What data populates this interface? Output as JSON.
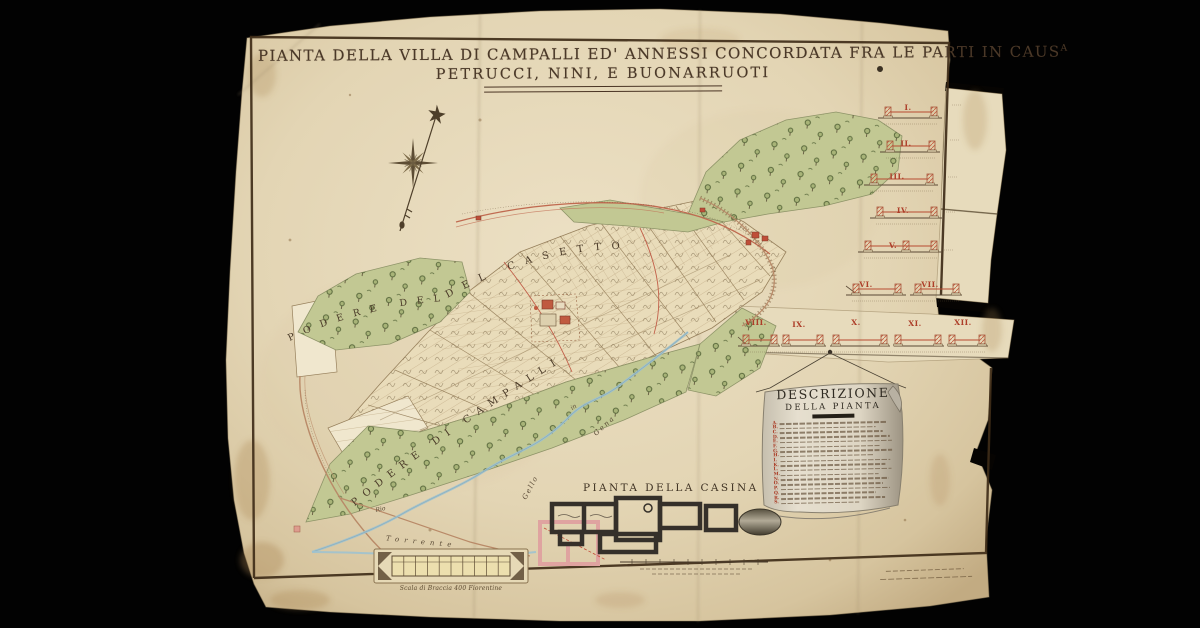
{
  "title": {
    "line1": "PIANTA DELLA VILLA DI CAMPALLI ED' ANNESSI CONCORDATA FRA LE PARTI IN CAUS",
    "line1_sup": "A",
    "line2": "PETRUCCI, NINI, E BUONARRUOTI"
  },
  "legend": {
    "title_line1": "DESCRIZIONE",
    "title_line2": "DELLA PIANTA",
    "items": [
      "A.",
      "B.",
      "C.",
      "D.",
      "E.",
      "F.",
      "G.",
      "H.",
      "I.",
      "K.",
      "L.",
      "M.",
      "N.",
      "O.",
      "P.",
      "Q.",
      "R.",
      "S."
    ]
  },
  "casina": {
    "title": "PIANTA DELLA CASINA"
  },
  "scale": {
    "caption": "Scala di Braccia 400 Fiorentine"
  },
  "sections": {
    "labels": [
      "I.",
      "II.",
      "III.",
      "IV.",
      "V.",
      "VI.",
      "VII.",
      "VIII.",
      "IX.",
      "X.",
      "XI.",
      "XII."
    ]
  },
  "map_labels": {
    "castelletto": "DEL CASETTO",
    "campalli": "PODERE DI CAMPALLI",
    "podere_del": "PODERE DEL",
    "gena": "Gena",
    "gello": "Gello",
    "torrente": "Torrente",
    "rio": "Rio",
    "in_word": "in"
  },
  "colors": {
    "paper": "#e3d5b4",
    "ink": "#4a3a28",
    "red": "#b84a30",
    "woods": "#c2c893",
    "river": "#9fc2cf"
  }
}
